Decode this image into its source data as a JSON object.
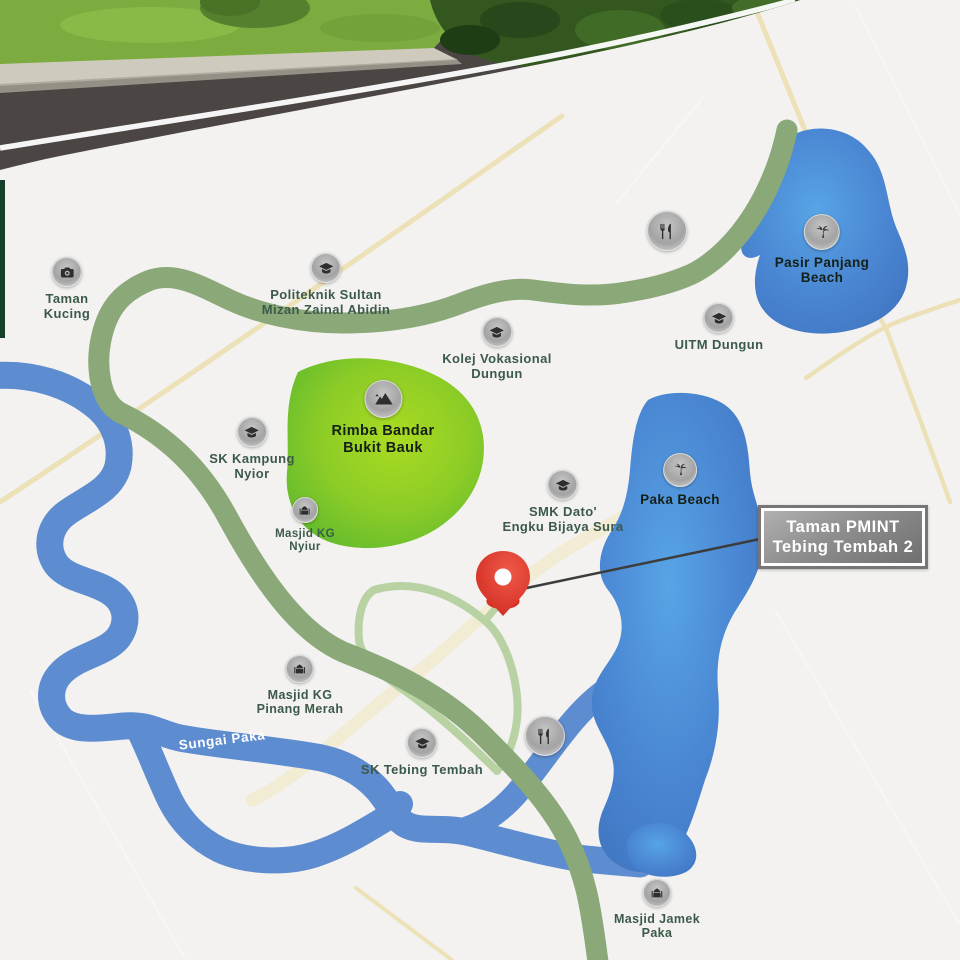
{
  "map_type": "project-location-map",
  "callout": {
    "line1": "Taman PMINT",
    "line2": "Tebing Tembah 2"
  },
  "river_label": "Sungai Paka",
  "colors": {
    "background": "#f3f2f0",
    "road_main": "#8aa878",
    "road_minor": "#b9d2a3",
    "road_sand": "#ecdfb2",
    "river": "#5d8cd0",
    "lake_center": "#55a0e6",
    "lake_edge": "#3f74c0",
    "forest_center": "#aadb21",
    "forest_edge": "#5eb92e",
    "label_green": "#3c5a49",
    "label_black": "#141f17",
    "pin_red": "#d93025",
    "callout_gray": "#8e8e8e"
  },
  "markers": [
    {
      "id": "taman-kucing",
      "icon": "camera",
      "x": 67,
      "y": 272,
      "size": 30,
      "font": 13,
      "color": "green",
      "label": [
        "Taman",
        "Kucing"
      ]
    },
    {
      "id": "politeknik-sultan-mizan",
      "icon": "graduation",
      "x": 326,
      "y": 268,
      "size": 30,
      "font": 13,
      "color": "green",
      "label": [
        "Politeknik Sultan",
        "Mizan Zainal Abidin"
      ]
    },
    {
      "id": "kolej-vokasional-dungun",
      "icon": "graduation",
      "x": 497,
      "y": 332,
      "size": 30,
      "font": 13,
      "color": "green",
      "label": [
        "Kolej Vokasional",
        "Dungun"
      ]
    },
    {
      "id": "uitm-dungun",
      "icon": "graduation",
      "x": 719,
      "y": 318,
      "size": 30,
      "font": 13,
      "color": "green",
      "label": [
        "UITM Dungun"
      ]
    },
    {
      "id": "pasir-panjang-beach",
      "icon": "palm",
      "x": 822,
      "y": 232,
      "size": 36,
      "font": 13.5,
      "color": "black",
      "label": [
        "Pasir Panjang",
        "Beach"
      ]
    },
    {
      "id": "restaurant-north",
      "icon": "utensils",
      "x": 667,
      "y": 231,
      "size": 40,
      "font": 13,
      "color": "green",
      "label": []
    },
    {
      "id": "rimba-bandar-bukit-bauk",
      "icon": "mountain",
      "x": 383,
      "y": 399,
      "size": 38,
      "font": 14.5,
      "color": "black",
      "label": [
        "Rimba Bandar",
        "Bukit Bauk"
      ]
    },
    {
      "id": "sk-kampung-nyior",
      "icon": "graduation",
      "x": 252,
      "y": 432,
      "size": 30,
      "font": 13,
      "color": "green",
      "label": [
        "SK Kampung",
        "Nyior"
      ]
    },
    {
      "id": "masjid-kg-nyiur",
      "icon": "mosque",
      "x": 305,
      "y": 510,
      "size": 26,
      "font": 11.5,
      "color": "green",
      "label": [
        "Masjid KG",
        "Nyiur"
      ]
    },
    {
      "id": "smk-dato-engku-bijaya-sura",
      "icon": "graduation",
      "x": 563,
      "y": 485,
      "size": 30,
      "font": 13,
      "color": "green",
      "label": [
        "SMK Dato'",
        "Engku Bijaya Sura"
      ]
    },
    {
      "id": "paka-beach",
      "icon": "palm",
      "x": 680,
      "y": 470,
      "size": 34,
      "font": 13.5,
      "color": "black",
      "label": [
        "Paka Beach"
      ]
    },
    {
      "id": "masjid-kg-pinang-merah",
      "icon": "mosque",
      "x": 300,
      "y": 669,
      "size": 28,
      "font": 12.5,
      "color": "green",
      "label": [
        "Masjid KG",
        "Pinang Merah"
      ]
    },
    {
      "id": "sk-tebing-tembah",
      "icon": "graduation",
      "x": 422,
      "y": 743,
      "size": 30,
      "font": 13,
      "color": "green",
      "label": [
        "SK Tebing Tembah"
      ]
    },
    {
      "id": "restaurant-south",
      "icon": "utensils",
      "x": 545,
      "y": 736,
      "size": 40,
      "font": 13,
      "color": "green",
      "label": []
    },
    {
      "id": "masjid-jamek-paka",
      "icon": "mosque",
      "x": 657,
      "y": 893,
      "size": 28,
      "font": 12.5,
      "color": "green",
      "label": [
        "Masjid Jamek",
        "Paka"
      ]
    }
  ]
}
